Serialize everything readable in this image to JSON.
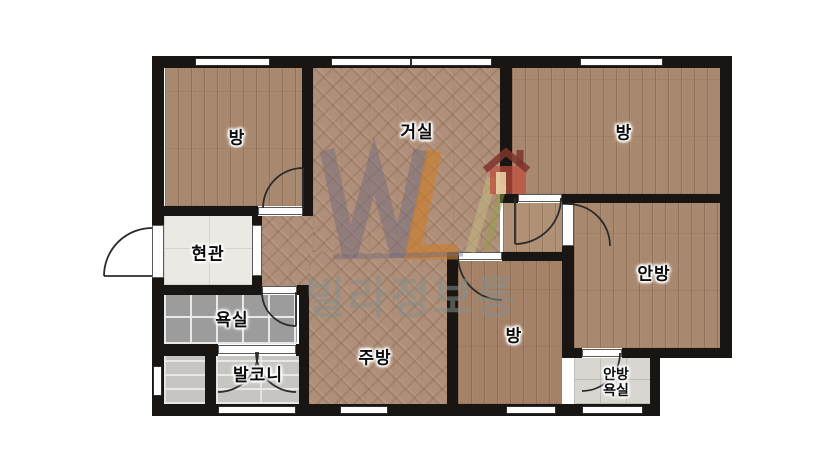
{
  "plan": {
    "rooms": [
      {
        "name": "room-top-left",
        "label": "방",
        "position": "top-left"
      },
      {
        "name": "living-room",
        "label": "거실",
        "position": "top-center"
      },
      {
        "name": "room-top-right",
        "label": "방",
        "position": "top-right"
      },
      {
        "name": "entrance",
        "label": "현관",
        "position": "middle-left"
      },
      {
        "name": "bathroom",
        "label": "욕실",
        "position": "left-lower"
      },
      {
        "name": "balcony",
        "label": "발코니",
        "position": "bottom-left"
      },
      {
        "name": "kitchen",
        "label": "주방",
        "position": "bottom-center"
      },
      {
        "name": "room-bottom",
        "label": "방",
        "position": "bottom-center-right"
      },
      {
        "name": "master-bedroom",
        "label": "안방",
        "position": "right"
      },
      {
        "name": "master-bathroom",
        "label": "안방 욕실",
        "lines": [
          "안방",
          "욕실"
        ],
        "position": "bottom-right"
      }
    ],
    "watermark": {
      "text": "빌라정보통",
      "logo": "house-icon",
      "colors": {
        "letter_w": "#736c7d",
        "letter_l": "#cd7d2d",
        "house_roof": "#7e352c",
        "house_body": "#c34b3c",
        "accent_green": "#96a050",
        "accent_tan": "#c3b982"
      }
    },
    "colors": {
      "wall": "#181512",
      "wood_floor": "#a8886e",
      "parquet_floor": "#af8f79",
      "entrance_tile": "#ebe9e4",
      "bath_tile": "#9b9c9b",
      "balcony_tile": "#c7c5c2",
      "master_bath_tile": "#d9d6d1"
    }
  }
}
